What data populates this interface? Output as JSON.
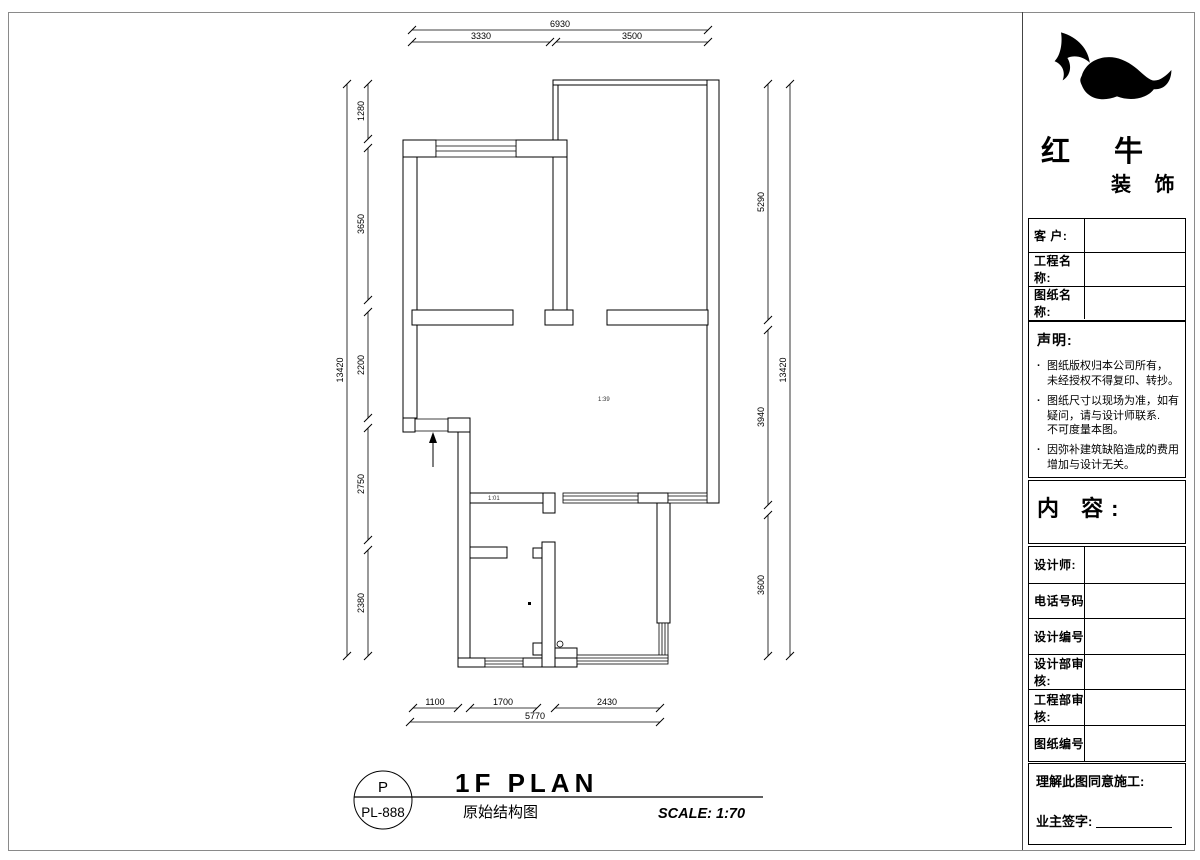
{
  "brand": {
    "name_top": "红 牛",
    "name_bottom": "装 饰"
  },
  "title_block": {
    "fields_top": [
      {
        "label": "客  户:"
      },
      {
        "label": "工程名称:"
      },
      {
        "label": "图纸名称:"
      }
    ],
    "statement": {
      "heading": "声明:",
      "bullet": "·",
      "items": [
        "图纸版权归本公司所有，\n未经授权不得复印、转抄。",
        "图纸尺寸以现场为准，如有\n疑问，请与设计师联系.\n不可度量本图。",
        "因弥补建筑缺陷造成的费用\n增加与设计无关。"
      ]
    },
    "content_label": "内 容:",
    "fields_bottom": [
      {
        "label": "设计师:"
      },
      {
        "label": "电话号码"
      },
      {
        "label": "设计编号"
      },
      {
        "label": "设计部审核:"
      },
      {
        "label": "工程部审核:"
      },
      {
        "label": "图纸编号"
      }
    ],
    "footer": {
      "construction_consent": "理解此图同意施工:",
      "owner_signature": "业主签字:"
    }
  },
  "drawing_title": {
    "code_letter": "P",
    "code_number": "PL-888",
    "title": "1F PLAN",
    "subtitle": "原始结构图",
    "scale": "SCALE: 1:70"
  },
  "dims": {
    "top": {
      "total": "6930",
      "segments": [
        "3330",
        "3500"
      ]
    },
    "left": {
      "total": "13420",
      "segments": [
        "1280",
        "3650",
        "2200",
        "2750",
        "2380"
      ]
    },
    "right": {
      "total": "13420",
      "segments": [
        "5290",
        "3940",
        "3600"
      ]
    },
    "bottom": {
      "total": "5770",
      "segments": [
        "1100",
        "1700",
        "2430"
      ]
    }
  },
  "plan_annotations": {
    "note_a": "1:39",
    "note_b": "1:01"
  }
}
